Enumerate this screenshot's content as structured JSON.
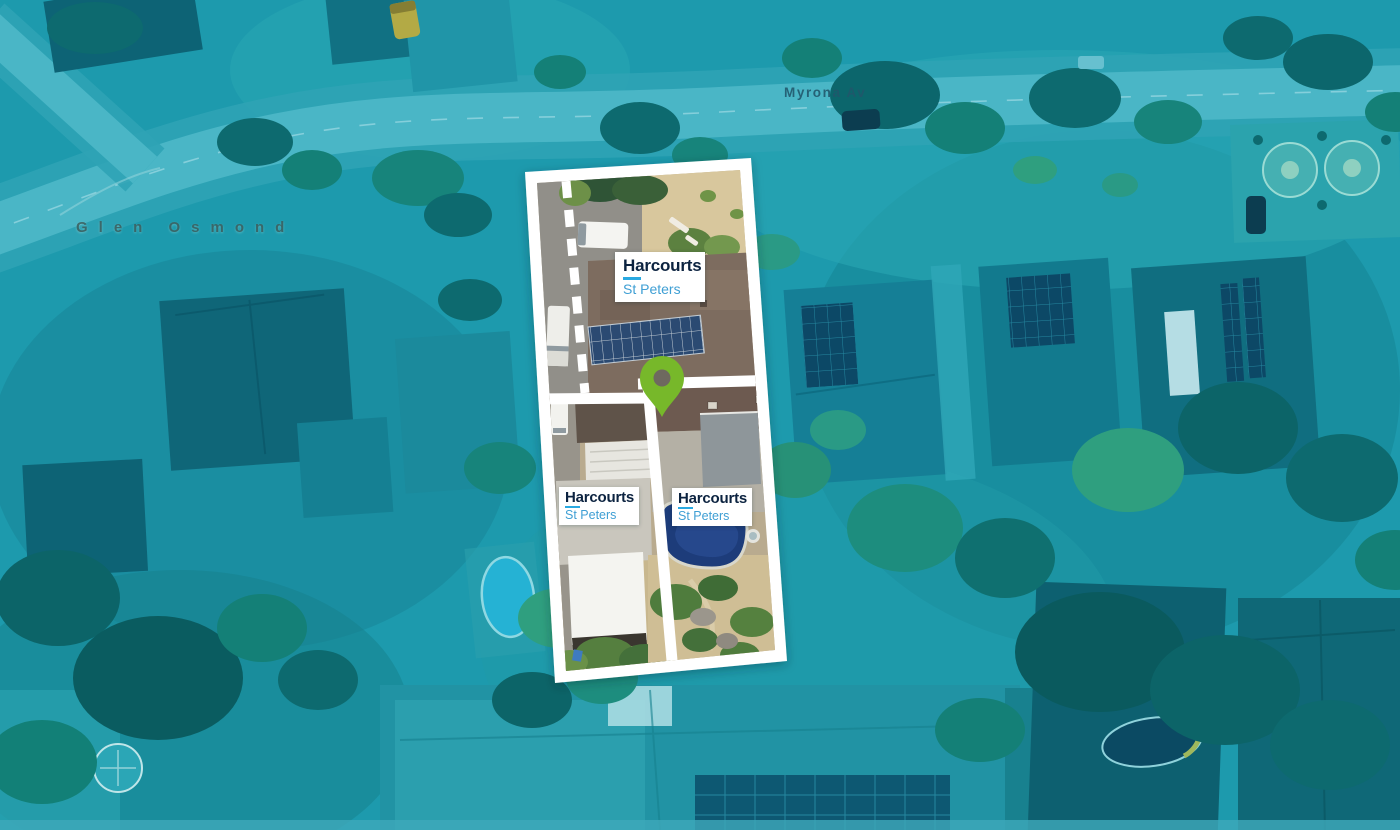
{
  "map": {
    "locality_label": {
      "text": "Glen Osmond"
    },
    "street_label": {
      "text": "Myrona Av"
    }
  },
  "property": {
    "markers": [
      {
        "brand": "Harcourts",
        "office": "St Peters"
      },
      {
        "brand": "Harcourts",
        "office": "St Peters"
      },
      {
        "brand": "Harcourts",
        "office": "St Peters"
      }
    ]
  },
  "theme": {
    "brand_navy": "#0c2340",
    "office_blue": "#3f9fd4",
    "underline_cyan": "#29a9e1",
    "pin_green": "#77b82a",
    "map_teal": "#1d9aad",
    "frame_white": "#ffffff",
    "street_label": "#21576b",
    "locality_label": "#3e5f5e"
  }
}
